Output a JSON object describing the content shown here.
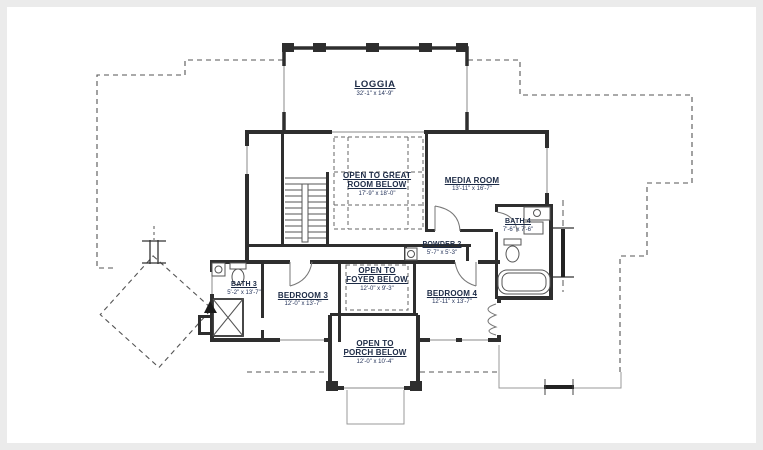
{
  "drawing": {
    "type": "second-floor plan",
    "paper_color": "#ffffff",
    "frame_color": "#ebebeb",
    "wall_color": "#2e2e2e",
    "label_color": "#1c2a45",
    "dashed_line_meaning": "roof / open-to-below outline"
  },
  "rooms": [
    {
      "id": "loggia",
      "line1": "LOGGIA",
      "line2": "",
      "dim": "32'-1\" x 14'-9\""
    },
    {
      "id": "open-to-great-room",
      "line1": "OPEN TO GREAT",
      "line2": "ROOM BELOW",
      "dim": "17'-9\" x 18'-0\""
    },
    {
      "id": "media-room",
      "line1": "MEDIA ROOM",
      "line2": "",
      "dim": "13'-11\" x 16'-7\""
    },
    {
      "id": "bath-4",
      "line1": "BATH 4",
      "line2": "",
      "dim": "7'-6\" x 7'-6\""
    },
    {
      "id": "powder-2",
      "line1": "POWDER 2",
      "line2": "",
      "dim": "5'-7\" x 5'-3\""
    },
    {
      "id": "open-to-foyer",
      "line1": "OPEN TO",
      "line2": "FOYER BELOW",
      "dim": "12'-0\" x 9'-3\""
    },
    {
      "id": "bath-3",
      "line1": "BATH 3",
      "line2": "",
      "dim": "5'-2\" x 13'-7\""
    },
    {
      "id": "bedroom-3",
      "line1": "BEDROOM 3",
      "line2": "",
      "dim": "12'-0\" x 13'-7\""
    },
    {
      "id": "bedroom-4",
      "line1": "BEDROOM 4",
      "line2": "",
      "dim": "12'-11\" x 13'-7\""
    },
    {
      "id": "open-to-porch",
      "line1": "OPEN TO",
      "line2": "PORCH BELOW",
      "dim": "12'-0\" x 10'-4\""
    }
  ]
}
